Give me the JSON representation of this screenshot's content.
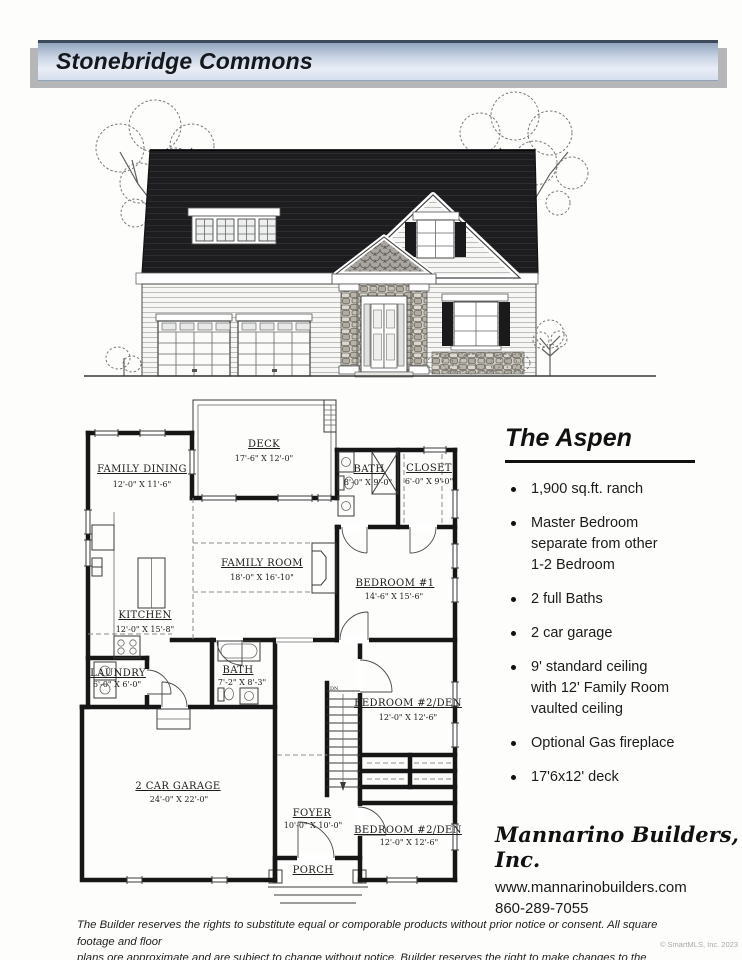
{
  "banner": {
    "title": "Stonebridge Commons"
  },
  "floor_plan": {
    "stair_label": "DN",
    "rooms": [
      {
        "name": "FAMILY DINING",
        "dims": "12'-0\" X 11'-6\""
      },
      {
        "name": "DECK",
        "dims": "17'-6\" X 12'-0\""
      },
      {
        "name": "BATH",
        "dims": "8'-0\" X 9'-0\""
      },
      {
        "name": "CLOSET",
        "dims": "6'-0\" X 9'-0\""
      },
      {
        "name": "FAMILY ROOM",
        "dims": "18'-0\" X 16'-10\""
      },
      {
        "name": "BEDROOM #1",
        "dims": "14'-6\" X 15'-6\""
      },
      {
        "name": "KITCHEN",
        "dims": "12'-0\" X 15'-8\""
      },
      {
        "name": "LAUNDRY",
        "dims": "6'-0\" X 6'-0\""
      },
      {
        "name": "BATH",
        "dims": "7'-2\" X 8'-3\""
      },
      {
        "name": "2 CAR GARAGE",
        "dims": "24'-0\" X 22'-0\""
      },
      {
        "name": "BEDROOM #2/DEN",
        "dims": "12'-0\" X 12'-6\""
      },
      {
        "name": "FOYER",
        "dims": "10'-0\" X 10'-0\""
      },
      {
        "name": "BEDROOM #2/DEN",
        "dims": "12'-0\" X 12'-6\""
      },
      {
        "name": "PORCH",
        "dims": ""
      }
    ]
  },
  "model": {
    "name": "The Aspen",
    "features": [
      "1,900 sq.ft. ranch",
      "Master Bedroom\nseparate from other\n1-2 Bedroom",
      "2 full Baths",
      "2 car garage",
      "9' standard ceiling\nwith 12' Family Room\nvaulted ceiling",
      "Optional Gas fireplace",
      "17'6x12' deck"
    ]
  },
  "builder": {
    "name": "Mannarino Builders, Inc.",
    "website": "www.mannarinobuilders.com",
    "phone": "860-289-7055"
  },
  "disclaimer": {
    "line1": "The Builder reserves the rights to substitute equal or comporable products without prior notice or consent. All square footage and floor",
    "line2": "plans ore approximate and are subject to change without notice. Builder reserves the right to make changes to the exterior elevations."
  },
  "copyright": "© SmartMLS, Inc. 2023"
}
